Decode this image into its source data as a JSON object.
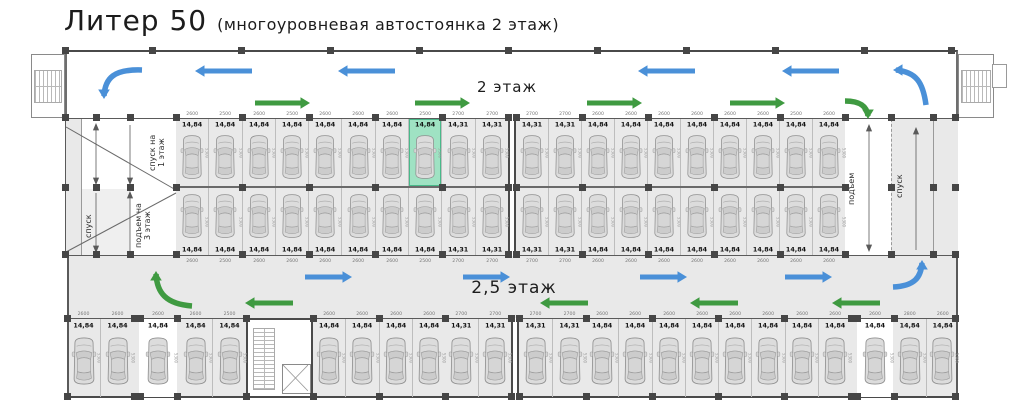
{
  "title": {
    "main": "Литер 50",
    "sub": "(многоуровневая автостоянка 2 этаж)"
  },
  "labels": {
    "floor_top": "2 этаж",
    "floor_bottom": "2,5 этаж",
    "ramp_down_1": "спуск на\n1 этаж",
    "ramp_down_left": "спуск",
    "ramp_up_3": "подъем на\n3 этаж",
    "ramp_up_right": "подъем",
    "ramp_down_right": "спуск",
    "depth_dim": "5300"
  },
  "colors": {
    "blue": "#4a90d8",
    "green": "#3f9a41",
    "highlight": "#9fe2c3",
    "highlight_border": "#49b98a",
    "area_gray": "#e9e9e9",
    "wall": "#4a4a4a"
  },
  "rows": {
    "upper_left": [
      {
        "l": "14,84",
        "d": "2600"
      },
      {
        "l": "14,84",
        "d": "2500"
      },
      {
        "l": "14,84",
        "d": "2600"
      },
      {
        "l": "14,84",
        "d": "2500"
      },
      {
        "l": "14,84",
        "d": "2600"
      },
      {
        "l": "14,84",
        "d": "2600"
      },
      {
        "l": "14,84",
        "d": "2600"
      },
      {
        "l": "14,84",
        "d": "2500",
        "selected": true
      },
      {
        "l": "14,31",
        "d": "2700"
      },
      {
        "l": "14,31",
        "d": "2700"
      }
    ],
    "upper_right": [
      {
        "l": "14,31",
        "d": "2700"
      },
      {
        "l": "14,31",
        "d": "2700"
      },
      {
        "l": "14,84",
        "d": "2600"
      },
      {
        "l": "14,84",
        "d": "2600"
      },
      {
        "l": "14,84",
        "d": "2600"
      },
      {
        "l": "14,84",
        "d": "2600"
      },
      {
        "l": "14,84",
        "d": "2600"
      },
      {
        "l": "14,84",
        "d": "2600"
      },
      {
        "l": "14,84",
        "d": "2500"
      },
      {
        "l": "14,84",
        "d": "2600"
      }
    ],
    "lower_left": [
      {
        "l": "14,84",
        "d": "2600"
      },
      {
        "l": "14,84",
        "d": "2500"
      },
      {
        "l": "14,84",
        "d": "2600"
      },
      {
        "l": "14,84",
        "d": "2600"
      },
      {
        "l": "14,84",
        "d": "2600"
      },
      {
        "l": "14,84",
        "d": "2600"
      },
      {
        "l": "14,84",
        "d": "2600"
      },
      {
        "l": "14,84",
        "d": "2500"
      },
      {
        "l": "14,31",
        "d": "2700"
      },
      {
        "l": "14,31",
        "d": "2700"
      }
    ],
    "lower_right": [
      {
        "l": "14,31",
        "d": "2700"
      },
      {
        "l": "14,31",
        "d": "2700"
      },
      {
        "l": "14,84",
        "d": "2600"
      },
      {
        "l": "14,84",
        "d": "2600"
      },
      {
        "l": "14,84",
        "d": "2600"
      },
      {
        "l": "14,84",
        "d": "2600"
      },
      {
        "l": "14,84",
        "d": "2600"
      },
      {
        "l": "14,84",
        "d": "2600"
      },
      {
        "l": "14,84",
        "d": "2600"
      },
      {
        "l": "14,84",
        "d": "2600"
      }
    ],
    "bottom_segments": {
      "a": [
        {
          "l": "14,84",
          "d": "2600"
        },
        {
          "l": "14,84",
          "d": "2600"
        }
      ],
      "b": [
        {
          "l": "14,84",
          "d": "2600"
        }
      ],
      "c": [
        {
          "l": "14,84",
          "d": "2600"
        },
        {
          "l": "14,84",
          "d": "2500"
        }
      ],
      "d": [
        {
          "l": "14,84",
          "d": "2600"
        },
        {
          "l": "14,84",
          "d": "2600"
        },
        {
          "l": "14,84",
          "d": "2600"
        },
        {
          "l": "14,84",
          "d": "2600"
        }
      ],
      "e": [
        {
          "l": "14,31",
          "d": "2700"
        },
        {
          "l": "14,31",
          "d": "2700"
        }
      ],
      "f": [
        {
          "l": "14,31",
          "d": "2700"
        },
        {
          "l": "14,31",
          "d": "2700"
        }
      ],
      "g": [
        {
          "l": "14,84",
          "d": "2600"
        },
        {
          "l": "14,84",
          "d": "2600"
        },
        {
          "l": "14,84",
          "d": "2600"
        },
        {
          "l": "14,84",
          "d": "2600"
        },
        {
          "l": "14,84",
          "d": "2600"
        },
        {
          "l": "14,84",
          "d": "2600"
        },
        {
          "l": "14,84",
          "d": "2600"
        },
        {
          "l": "14,84",
          "d": "2600"
        }
      ],
      "h": [
        {
          "l": "14,84",
          "d": "2600"
        }
      ],
      "i": [
        {
          "l": "14,84",
          "d": "2800"
        },
        {
          "l": "14,84",
          "d": "2600"
        }
      ]
    }
  },
  "traffic_arrows": {
    "straight": [
      {
        "color": "blue",
        "dir": "left",
        "x": 195,
        "y": 71,
        "len": 57
      },
      {
        "color": "blue",
        "dir": "left",
        "x": 338,
        "y": 71,
        "len": 57
      },
      {
        "color": "blue",
        "dir": "left",
        "x": 638,
        "y": 71,
        "len": 57
      },
      {
        "color": "blue",
        "dir": "left",
        "x": 782,
        "y": 71,
        "len": 57
      },
      {
        "color": "green",
        "dir": "right",
        "x": 255,
        "y": 103,
        "len": 55
      },
      {
        "color": "green",
        "dir": "right",
        "x": 415,
        "y": 103,
        "len": 55
      },
      {
        "color": "green",
        "dir": "right",
        "x": 587,
        "y": 103,
        "len": 55
      },
      {
        "color": "green",
        "dir": "right",
        "x": 730,
        "y": 103,
        "len": 55
      },
      {
        "color": "blue",
        "dir": "right",
        "x": 305,
        "y": 277,
        "len": 47
      },
      {
        "color": "blue",
        "dir": "right",
        "x": 463,
        "y": 277,
        "len": 47
      },
      {
        "color": "blue",
        "dir": "right",
        "x": 640,
        "y": 277,
        "len": 47
      },
      {
        "color": "blue",
        "dir": "right",
        "x": 785,
        "y": 277,
        "len": 47
      },
      {
        "color": "green",
        "dir": "left",
        "x": 245,
        "y": 303,
        "len": 48
      },
      {
        "color": "green",
        "dir": "left",
        "x": 540,
        "y": 303,
        "len": 48
      },
      {
        "color": "green",
        "dir": "left",
        "x": 690,
        "y": 303,
        "len": 48
      },
      {
        "color": "green",
        "dir": "left",
        "x": 832,
        "y": 303,
        "len": 48
      }
    ],
    "curved": [
      {
        "color": "blue",
        "path": "M142,70 C114,69 105,78 104,96",
        "hx": 104,
        "hy": 99,
        "angle": 90
      },
      {
        "color": "blue",
        "path": "M926,105 C923,82 916,72 896,70",
        "hx": 893,
        "hy": 70,
        "angle": 180
      },
      {
        "color": "green",
        "path": "M845,101 C861,101 867,107 868,116",
        "hx": 868,
        "hy": 119,
        "angle": 90
      },
      {
        "color": "green",
        "path": "M192,306 C166,304 157,293 156,274",
        "hx": 156,
        "hy": 271,
        "angle": 270
      },
      {
        "color": "blue",
        "path": "M893,287 C915,286 921,277 922,263",
        "hx": 922,
        "hy": 260,
        "angle": 270
      }
    ]
  }
}
